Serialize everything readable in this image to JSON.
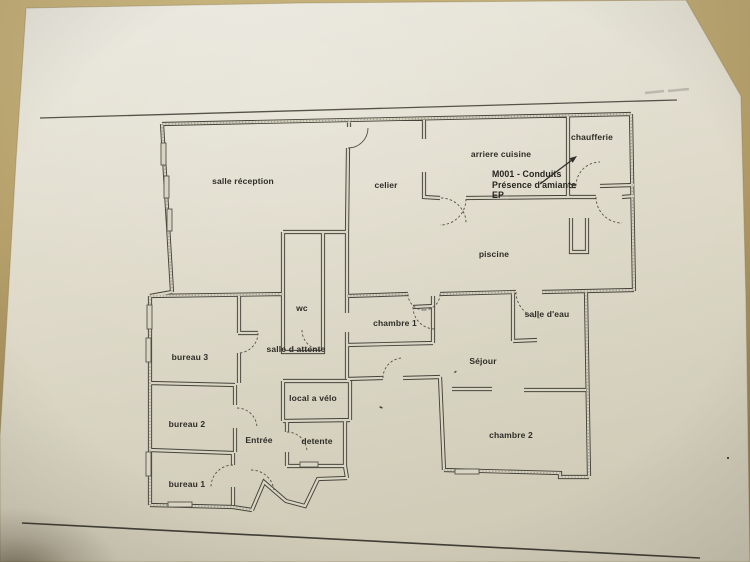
{
  "photo": {
    "rooms": {
      "salle_reception": "salle réception",
      "celier": "celier",
      "arriere_cuisine": "arriere cuisine",
      "chaufferie": "chaufferie",
      "piscine": "piscine",
      "wc": "wc",
      "chambre_1": "chambre 1",
      "salle_d_eau": "salle d'eau",
      "salle_d_attente": "salle d attente",
      "bureau_3": "bureau 3",
      "sejour": "Séjour",
      "bureau_2": "bureau 2",
      "local_a_velo": "local a vélo",
      "entree": "Entrée",
      "detente": "detente",
      "bureau_1": "bureau 1",
      "chambre_2": "chambre 2"
    },
    "annotation": {
      "line1": "M001 - Conduits",
      "line2": "Présence d'amiante",
      "line3": "EP"
    },
    "colors": {
      "table": "#b39d68",
      "paper": "#ded9c8",
      "ink": "#46433c"
    }
  }
}
